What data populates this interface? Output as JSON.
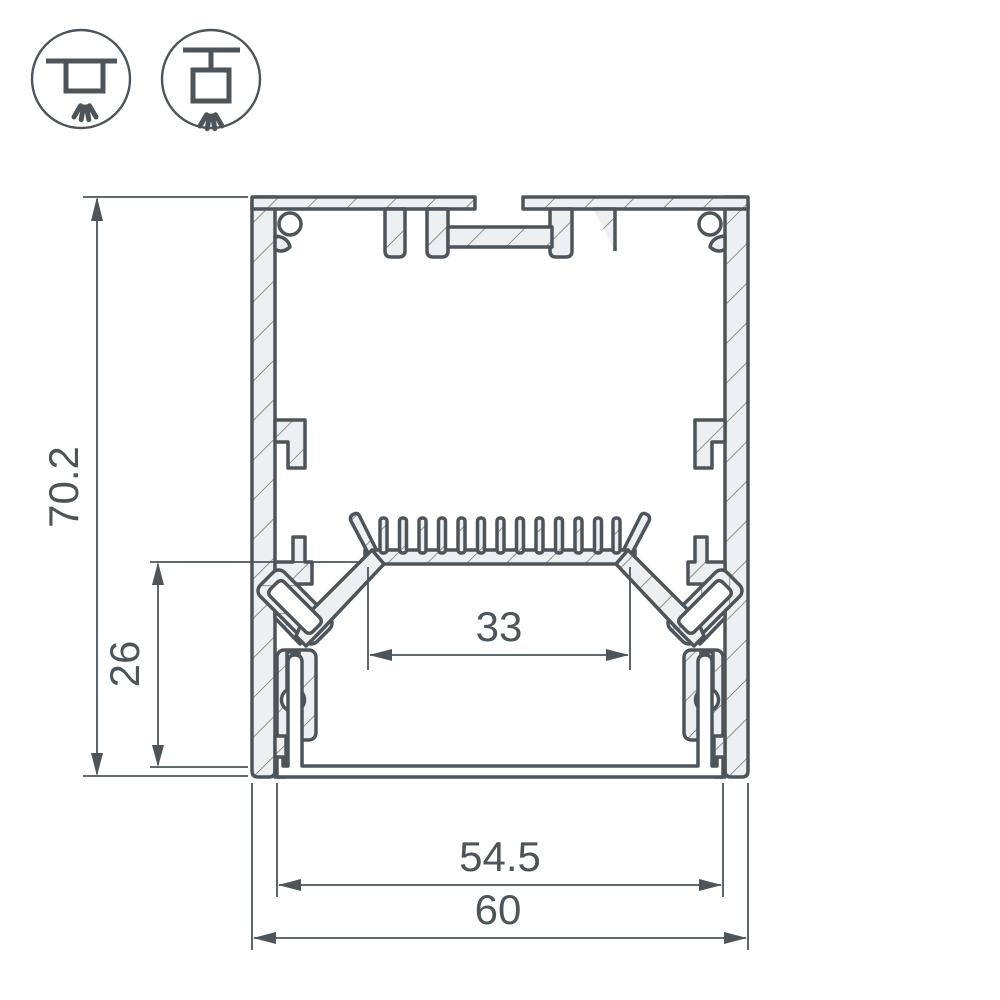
{
  "drawing": {
    "title": "LED profile cross-section technical drawing",
    "dimensions": {
      "overall_height": "70.2",
      "inner_height": "26",
      "led_platform_width": "33",
      "inner_bottom_width": "54.5",
      "overall_width": "60"
    },
    "icons": [
      {
        "name": "surface-mount-light-icon",
        "meaning": "surface ceiling mount, light directed down"
      },
      {
        "name": "pendant-mount-light-icon",
        "meaning": "suspended pendant mount, light directed down"
      }
    ],
    "colors": {
      "line": "#4d545a",
      "material_fill": "#edeff0",
      "hatch_line": "#6b7278",
      "background": "#ffffff"
    }
  }
}
